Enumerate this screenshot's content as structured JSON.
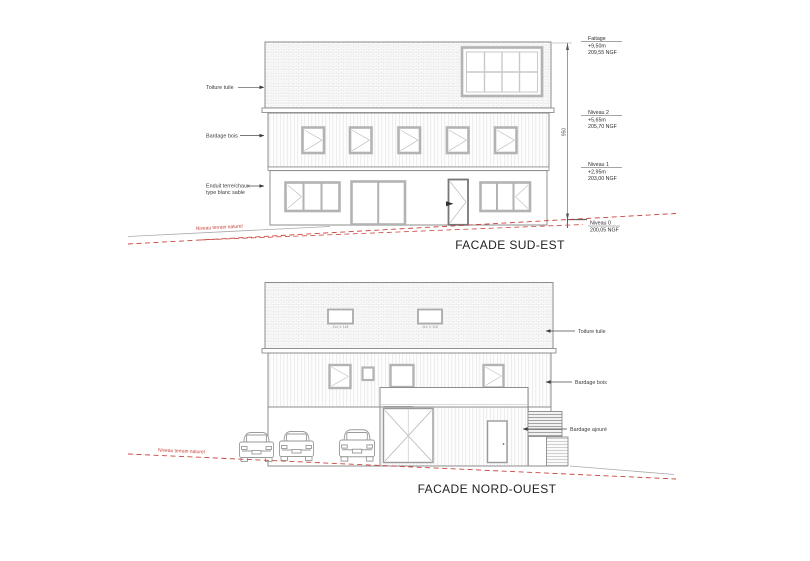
{
  "document": {
    "background": "#ffffff",
    "colors": {
      "line_gray": "#8c8c8c",
      "frame_gray": "#b3b3b3",
      "terrain_red": "#c8453d",
      "text": "#2e2e2e"
    }
  },
  "facade_sud_est": {
    "title": "FACADE SUD-EST",
    "material_labels": {
      "toiture": "Toiture tuile",
      "bardage": "Bardage bois",
      "enduit_line1": "Enduit terre/chaux",
      "enduit_line2": "type blanc sable"
    },
    "dimension_total": "950",
    "levels": [
      {
        "name": "Faitage",
        "height": "+9,50m",
        "ngf": "209,55 NGF"
      },
      {
        "name": "Niveau 2",
        "height": "+5,65m",
        "ngf": "205,70 NGF"
      },
      {
        "name": "Niveau 1",
        "height": "+2,95m",
        "ngf": "203,00 NGF"
      },
      {
        "name": "Niveau 0",
        "height": "",
        "ngf": "200,05 NGF"
      }
    ],
    "terrain_label": "Niveau terrain naturel"
  },
  "facade_nord_ouest": {
    "title": "FACADE NORD-OUEST",
    "material_labels": {
      "toiture": "Toiture tuile",
      "bardage": "Bardage bois",
      "ajoure": "Bardage ajouré"
    },
    "roof_window_labels": [
      "114 X 118",
      "114 X 118"
    ],
    "terrain_label": "Niveau terrain naturel"
  }
}
